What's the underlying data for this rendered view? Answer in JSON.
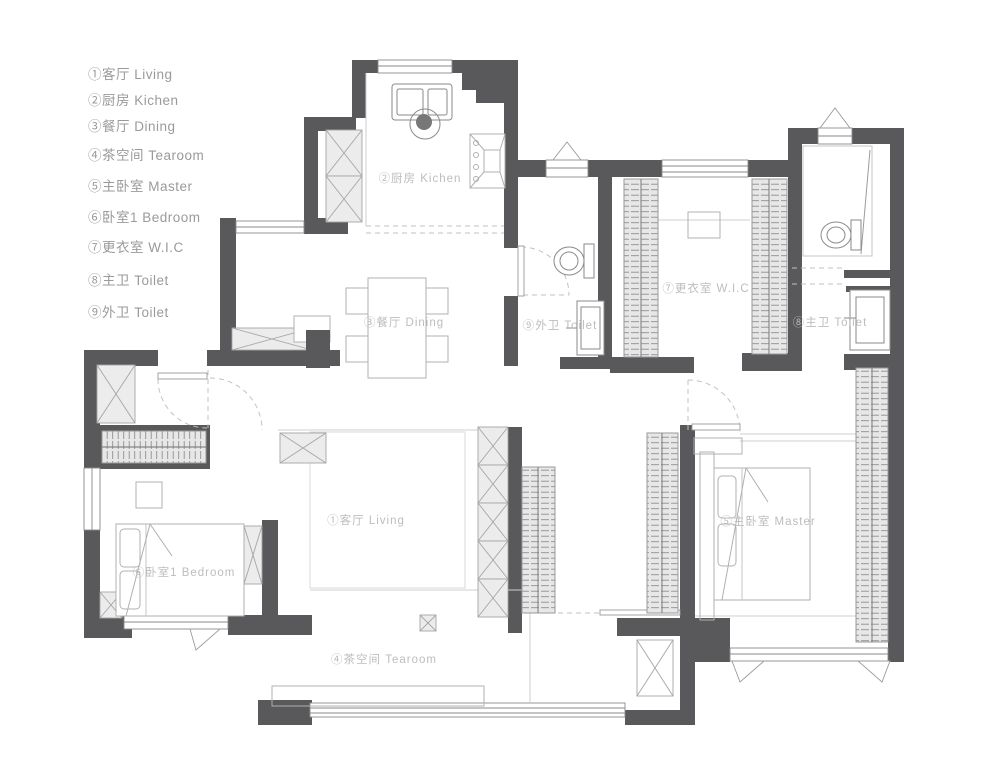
{
  "page_title": "Apartment floor plan",
  "colors": {
    "wall": "#59595b",
    "cabinet_fill": "#ececec",
    "wardrobe_fill": "#e7e7e7",
    "furniture_line": "#b0b0b0",
    "fixture_line": "#8a8a8a",
    "room_label": "#bdbdbd",
    "legend_text": "#9a9a9a",
    "background": "#ffffff"
  },
  "legend": {
    "items": [
      {
        "label": "①客厅 Living"
      },
      {
        "label": "②厨房 Kichen"
      },
      {
        "label": "③餐厅 Dining"
      },
      {
        "label": "④茶空间 Tearoom"
      },
      {
        "label": "⑤主卧室 Master"
      },
      {
        "label": "⑥卧室1 Bedroom"
      },
      {
        "label": "⑦更衣室 W.I.C"
      },
      {
        "label": "⑧主卫 Toilet"
      },
      {
        "label": "⑨外卫 Toilet"
      }
    ]
  },
  "plan": {
    "room_labels": {
      "kitchen": {
        "text": "②厨房 Kichen"
      },
      "dining": {
        "text": "③餐厅 Dining"
      },
      "toilet9": {
        "text": "⑨外卫 Toilet"
      },
      "wic": {
        "text": "⑦更衣室 W.I.C"
      },
      "toilet8": {
        "text": "⑧主卫 Toilet"
      },
      "living": {
        "text": "①客厅 Living"
      },
      "tearoom": {
        "text": "④茶空间 Tearoom"
      },
      "bedroom1": {
        "text": "⑥卧室1 Bedroom"
      },
      "master": {
        "text": "⑤主卧室 Master"
      }
    }
  }
}
